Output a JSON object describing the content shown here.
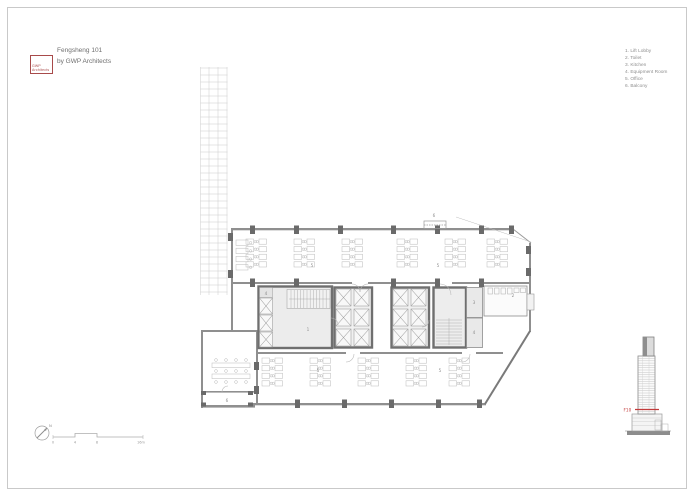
{
  "colors": {
    "accent_red": "#a84a4a",
    "section_marker_red": "#c23b3b",
    "wall_gray": "#8f8f8f",
    "column_gray": "#6a6a6a",
    "core_wall_gray": "#6f6f6f",
    "room_fill": "#ececec",
    "faint_line": "#cfcfcf",
    "text_gray": "#8f8f8f"
  },
  "header": {
    "logo_line1": "GWP",
    "logo_line2": "Architects",
    "title": "Fengsheng 101",
    "subtitle": "by GWP Architects"
  },
  "legend": {
    "items": [
      "1. Lift Lobby",
      "2. Toilet",
      "3. Kitchen",
      "4. Equipment Room",
      "5. Office",
      "6. Balcony"
    ]
  },
  "plan": {
    "labels": {
      "lift_lobby": "1",
      "toilet": "2",
      "kitchen": "3",
      "equipment": "4",
      "office": "5",
      "balcony": "6"
    }
  },
  "section": {
    "floor_marker": "F10"
  },
  "scalebar": {
    "north": "N",
    "ticks": [
      "0",
      "4",
      "8",
      "16m"
    ]
  }
}
